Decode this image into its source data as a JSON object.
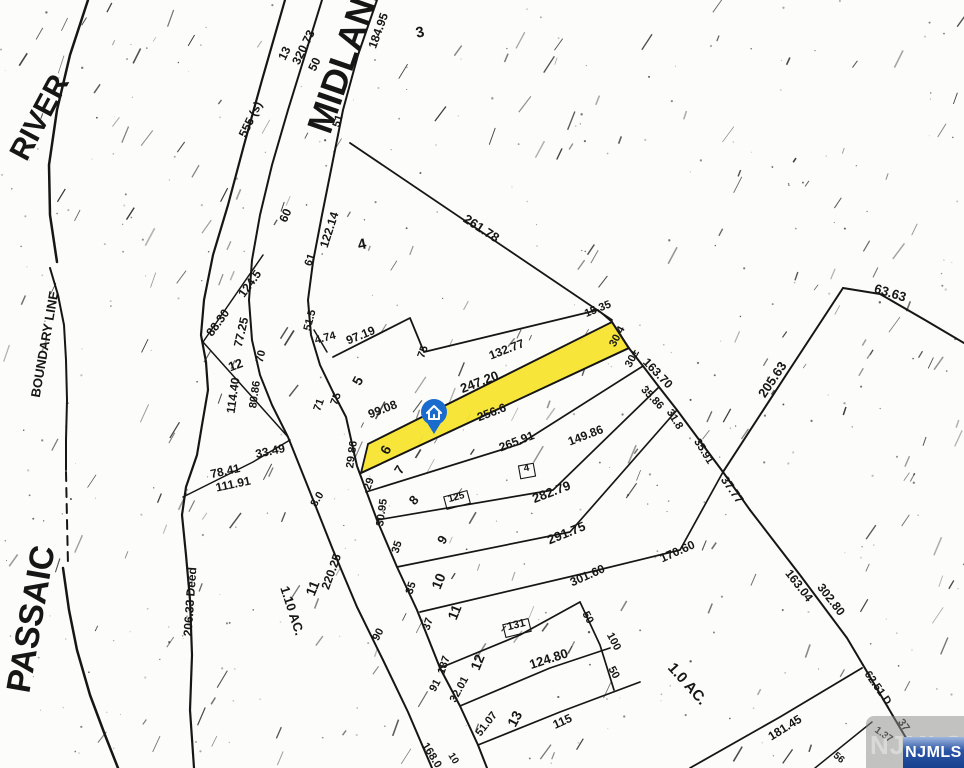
{
  "map": {
    "background": "#fcfcfa",
    "ink": "#161616",
    "highlighted_lot": {
      "points": "368,444 612,322 629,348 361,473",
      "fill": "#f7e52e",
      "lot_number": "6"
    },
    "pin": {
      "x": 434,
      "y": 415,
      "color": "#1a6bce",
      "icon": "house-icon"
    },
    "watermark": {
      "label": "NJMLS",
      "badge_top": "#9fb6de",
      "badge_mid": "#2a55a5",
      "badge_bottom": "#16418f",
      "text_color": "#ffffff"
    },
    "labels": [
      [
        "PASSAIC",
        42,
        621,
        -80,
        34
      ],
      [
        "RIVER",
        48,
        122,
        -62,
        30
      ],
      [
        "MIDLAND",
        357,
        57,
        -71,
        36
      ],
      [
        "BOUNDARY LINE",
        49,
        345,
        -80,
        13
      ],
      [
        "206.33 Deed",
        194,
        602,
        -86,
        12
      ],
      [
        "1.10 AC.",
        288,
        612,
        72,
        13
      ],
      [
        "1.0 AC.",
        684,
        687,
        48,
        15
      ],
      [
        "320.73",
        307,
        49,
        -64,
        12
      ],
      [
        "13",
        288,
        55,
        -64,
        12
      ],
      [
        "50",
        318,
        66,
        -64,
        12
      ],
      [
        "555 (s)",
        254,
        121,
        -64,
        12
      ],
      [
        "184.95",
        382,
        32,
        -70,
        12
      ],
      [
        "3",
        421,
        37,
        -12,
        15
      ],
      [
        "51",
        341,
        122,
        -72,
        11
      ],
      [
        "60",
        289,
        217,
        -66,
        12
      ],
      [
        "122.14",
        333,
        231,
        -72,
        12
      ],
      [
        "4",
        363,
        249,
        -12,
        15
      ],
      [
        "61",
        313,
        261,
        -70,
        11
      ],
      [
        "261.78",
        479,
        232,
        33,
        13
      ],
      [
        "88.30",
        221,
        325,
        -54,
        12
      ],
      [
        "124.5",
        253,
        286,
        -54,
        12
      ],
      [
        "77.25",
        245,
        333,
        -77,
        12
      ],
      [
        "70",
        264,
        357,
        -77,
        11
      ],
      [
        "12",
        237,
        369,
        -20,
        13
      ],
      [
        "80.86",
        258,
        395,
        -82,
        11
      ],
      [
        "114.40",
        237,
        396,
        -82,
        12
      ],
      [
        "51.5",
        313,
        321,
        -75,
        11
      ],
      [
        "4.74",
        326,
        341,
        -14,
        11
      ],
      [
        "97.19",
        362,
        339,
        -22,
        12
      ],
      [
        "75",
        426,
        353,
        -70,
        11
      ],
      [
        "5",
        362,
        383,
        -62,
        14
      ],
      [
        "75",
        339,
        400,
        -70,
        11
      ],
      [
        "71",
        322,
        406,
        -70,
        11
      ],
      [
        "33.49",
        271,
        455,
        -12,
        12
      ],
      [
        "78.41",
        226,
        475,
        -12,
        12
      ],
      [
        "111.91",
        234,
        488,
        -12,
        12
      ],
      [
        "132.77",
        508,
        353,
        -21,
        12
      ],
      [
        "247.20",
        481,
        386,
        -21,
        13
      ],
      [
        "99.08",
        384,
        413,
        -21,
        12
      ],
      [
        "6",
        390,
        452,
        -62,
        14
      ],
      [
        "29.86",
        355,
        455,
        -82,
        11
      ],
      [
        "15.35",
        599,
        312,
        -22,
        11
      ],
      [
        "30.4",
        620,
        338,
        -62,
        11
      ],
      [
        "30±",
        635,
        360,
        -62,
        11
      ],
      [
        "163.70",
        655,
        376,
        46,
        12
      ],
      [
        "35.86",
        650,
        400,
        46,
        11
      ],
      [
        "31.8",
        672,
        421,
        58,
        11
      ],
      [
        "35.91",
        701,
        453,
        58,
        11
      ],
      [
        "37.77",
        729,
        492,
        55,
        12
      ],
      [
        "205.63",
        776,
        382,
        -56,
        13
      ],
      [
        "63.63",
        889,
        297,
        17,
        13
      ],
      [
        "149.86",
        587,
        439,
        -21,
        12
      ],
      [
        "256.6",
        493,
        416,
        -21,
        12
      ],
      [
        "265.91",
        518,
        445,
        -21,
        12
      ],
      [
        "282.79",
        553,
        496,
        -21,
        13
      ],
      [
        "291.75",
        568,
        537,
        -22,
        13
      ],
      [
        "301.60",
        589,
        579,
        -24,
        12
      ],
      [
        "170.60",
        679,
        555,
        -24,
        12
      ],
      [
        "7",
        403,
        472,
        -58,
        13
      ],
      [
        "29",
        372,
        485,
        -70,
        11
      ],
      [
        "8",
        417,
        503,
        -48,
        13
      ],
      [
        "30.95",
        385,
        513,
        -82,
        11
      ],
      [
        "9",
        446,
        542,
        -58,
        13
      ],
      [
        "35",
        400,
        548,
        -72,
        11
      ],
      [
        "10",
        443,
        583,
        -68,
        14
      ],
      [
        "35",
        414,
        589,
        -72,
        11
      ],
      [
        "11",
        459,
        614,
        -68,
        14
      ],
      [
        "37",
        431,
        625,
        -72,
        11
      ],
      [
        "12",
        482,
        664,
        -68,
        14
      ],
      [
        "187",
        447,
        666,
        -72,
        11
      ],
      [
        "91",
        438,
        687,
        -62,
        11
      ],
      [
        "32.01",
        462,
        691,
        -62,
        11
      ],
      [
        "13",
        519,
        721,
        -62,
        14
      ],
      [
        "51.07",
        489,
        726,
        -52,
        11
      ],
      [
        "115",
        564,
        725,
        -24,
        12
      ],
      [
        "168.0",
        429,
        757,
        58,
        11
      ],
      [
        "10",
        451,
        760,
        58,
        10
      ],
      [
        "8.0",
        320,
        501,
        -58,
        11
      ],
      [
        "220.25",
        335,
        573,
        -70,
        12
      ],
      [
        "90",
        381,
        636,
        -62,
        11
      ],
      [
        "11",
        317,
        590,
        -68,
        14
      ],
      [
        "50",
        585,
        619,
        62,
        11
      ],
      [
        "100",
        611,
        643,
        62,
        11
      ],
      [
        "50",
        611,
        674,
        62,
        11
      ],
      [
        "124.80",
        550,
        663,
        -18,
        13
      ],
      [
        "163.04",
        796,
        588,
        52,
        12
      ],
      [
        "302.80",
        828,
        602,
        52,
        12
      ],
      [
        "181.45",
        787,
        731,
        -32,
        12
      ],
      [
        "62.51 D.",
        876,
        691,
        55,
        11
      ],
      [
        "37",
        901,
        727,
        55,
        11
      ],
      [
        "1.37",
        882,
        737,
        35,
        10
      ],
      [
        "56",
        837,
        760,
        40,
        10
      ],
      [
        "125",
        457,
        500,
        -15,
        10
      ],
      [
        "4",
        527,
        471,
        -10,
        10
      ],
      [
        "131",
        517,
        628,
        -14,
        11
      ]
    ],
    "boxes": [
      [
        457,
        500,
        24,
        13,
        -15
      ],
      [
        527,
        471,
        15,
        13,
        -10
      ],
      [
        517,
        628,
        26,
        13,
        -14
      ]
    ],
    "lines": [
      {
        "pts": [
          [
            88,
            0
          ],
          [
            70,
            55
          ],
          [
            57,
            110
          ],
          [
            49,
            165
          ],
          [
            50,
            215
          ],
          [
            57,
            262
          ]
        ],
        "w": 2.5
      },
      {
        "pts": [
          [
            50,
            268
          ],
          [
            58,
            295
          ],
          [
            64,
            325
          ],
          [
            66,
            360
          ],
          [
            67,
            400
          ],
          [
            66,
            440
          ],
          [
            66,
            470
          ]
        ],
        "w": 2
      },
      {
        "pts": [
          [
            66,
            472
          ],
          [
            67,
            520
          ],
          [
            68,
            565
          ]
        ],
        "w": 2,
        "dash": "9,7"
      },
      {
        "pts": [
          [
            63,
            568
          ],
          [
            69,
            610
          ],
          [
            77,
            650
          ],
          [
            90,
            695
          ],
          [
            105,
            735
          ],
          [
            118,
            768
          ]
        ],
        "w": 2.5
      },
      {
        "pts": [
          [
            285,
            0
          ],
          [
            262,
            80
          ],
          [
            244,
            145
          ],
          [
            228,
            205
          ],
          [
            213,
            255
          ],
          [
            204,
            300
          ],
          [
            201,
            335
          ],
          [
            206,
            362
          ],
          [
            208,
            390
          ],
          [
            202,
            425
          ],
          [
            197,
            455
          ],
          [
            186,
            487
          ],
          [
            182,
            515
          ],
          [
            186,
            555
          ],
          [
            190,
            600
          ],
          [
            192,
            655
          ],
          [
            190,
            710
          ],
          [
            194,
            768
          ]
        ],
        "w": 2.2
      },
      {
        "pts": [
          [
            322,
            0
          ],
          [
            305,
            55
          ],
          [
            288,
            110
          ],
          [
            272,
            165
          ],
          [
            260,
            215
          ],
          [
            252,
            260
          ],
          [
            249,
            300
          ],
          [
            252,
            340
          ],
          [
            260,
            375
          ],
          [
            272,
            405
          ],
          [
            288,
            437
          ],
          [
            310,
            492
          ],
          [
            333,
            550
          ],
          [
            357,
            607
          ],
          [
            383,
            660
          ],
          [
            408,
            712
          ],
          [
            432,
            768
          ]
        ],
        "w": 2
      },
      {
        "pts": [
          [
            377,
            0
          ],
          [
            358,
            55
          ],
          [
            343,
            110
          ],
          [
            332,
            165
          ],
          [
            322,
            215
          ],
          [
            313,
            262
          ],
          [
            308,
            300
          ],
          [
            311,
            335
          ],
          [
            320,
            365
          ],
          [
            333,
            392
          ],
          [
            346,
            417
          ],
          [
            357,
            466
          ],
          [
            377,
            520
          ],
          [
            397,
            567
          ],
          [
            417,
            610
          ],
          [
            440,
            668
          ],
          [
            460,
            706
          ],
          [
            478,
            745
          ],
          [
            487,
            768
          ]
        ],
        "w": 2
      },
      {
        "pts": [
          [
            350,
            143
          ],
          [
            612,
            320
          ]
        ],
        "w": 1.8
      },
      {
        "pts": [
          [
            333,
            357
          ],
          [
            410,
            318
          ],
          [
            424,
            352
          ],
          [
            598,
            310
          ],
          [
            612,
            322
          ]
        ],
        "w": 1.8
      },
      {
        "pts": [
          [
            368,
            444
          ],
          [
            612,
            322
          ]
        ],
        "w": 1.8
      },
      {
        "pts": [
          [
            361,
            473
          ],
          [
            629,
            348
          ]
        ],
        "w": 1.8
      },
      {
        "pts": [
          [
            612,
            322
          ],
          [
            628,
            347
          ],
          [
            643,
            366
          ],
          [
            659,
            387
          ],
          [
            677,
            410
          ],
          [
            697,
            437
          ],
          [
            723,
            472
          ],
          [
            750,
            510
          ]
        ],
        "w": 2
      },
      {
        "pts": [
          [
            366,
            492
          ],
          [
            520,
            444
          ],
          [
            643,
            366
          ]
        ],
        "w": 1.7
      },
      {
        "pts": [
          [
            377,
            520
          ],
          [
            553,
            490
          ],
          [
            659,
            387
          ]
        ],
        "w": 1.7
      },
      {
        "pts": [
          [
            397,
            567
          ],
          [
            570,
            532
          ],
          [
            677,
            410
          ]
        ],
        "w": 1.7
      },
      {
        "pts": [
          [
            420,
            612
          ],
          [
            590,
            572
          ],
          [
            680,
            550
          ],
          [
            723,
            472
          ]
        ],
        "w": 1.7
      },
      {
        "pts": [
          [
            440,
            668
          ],
          [
            520,
            635
          ],
          [
            580,
            602
          ]
        ],
        "w": 1.7
      },
      {
        "pts": [
          [
            580,
            602
          ],
          [
            600,
            645
          ],
          [
            614,
            690
          ]
        ],
        "w": 1.7
      },
      {
        "pts": [
          [
            460,
            706
          ],
          [
            550,
            668
          ],
          [
            610,
            648
          ]
        ],
        "w": 1.7
      },
      {
        "pts": [
          [
            478,
            745
          ],
          [
            560,
            712
          ],
          [
            640,
            682
          ]
        ],
        "w": 1.7
      },
      {
        "pts": [
          [
            750,
            510
          ],
          [
            800,
            575
          ],
          [
            847,
            638
          ],
          [
            863,
            665
          ]
        ],
        "w": 2
      },
      {
        "pts": [
          [
            863,
            665
          ],
          [
            893,
            716
          ]
        ],
        "w": 2
      },
      {
        "pts": [
          [
            893,
            716
          ],
          [
            912,
            748
          ]
        ],
        "w": 2
      },
      {
        "pts": [
          [
            690,
            768
          ],
          [
            780,
            717
          ],
          [
            862,
            668
          ]
        ],
        "w": 1.8
      },
      {
        "pts": [
          [
            815,
            768
          ],
          [
            872,
            722
          ]
        ],
        "w": 1.5
      },
      {
        "pts": [
          [
            843,
            288
          ],
          [
            880,
            294
          ],
          [
            925,
            320
          ],
          [
            964,
            343
          ]
        ],
        "w": 2
      },
      {
        "pts": [
          [
            843,
            288
          ],
          [
            788,
            372
          ],
          [
            723,
            472
          ]
        ],
        "w": 2
      },
      {
        "pts": [
          [
            203,
            342
          ],
          [
            263,
            255
          ]
        ],
        "w": 1.5
      },
      {
        "pts": [
          [
            203,
            342
          ],
          [
            288,
            437
          ]
        ],
        "w": 1.5
      },
      {
        "pts": [
          [
            183,
            497
          ],
          [
            253,
            462
          ],
          [
            290,
            440
          ]
        ],
        "w": 1.5
      },
      {
        "pts": [
          [
            314,
            330
          ],
          [
            327,
            352
          ]
        ],
        "w": 1.5
      }
    ]
  }
}
